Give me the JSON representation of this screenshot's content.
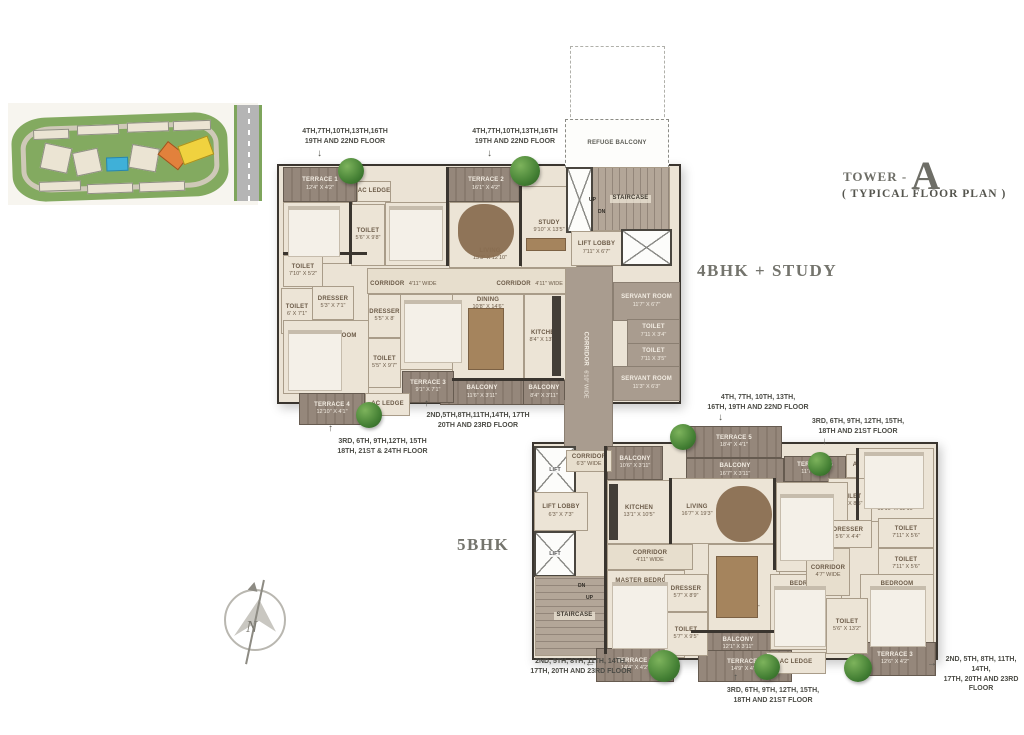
{
  "title": {
    "prefix": "TOWER -",
    "letter": "A",
    "subtitle": "( TYPICAL FLOOR PLAN )"
  },
  "units": {
    "upper": "4BHK + STUDY",
    "lower": "5BHK"
  },
  "compass": {
    "north": "N"
  },
  "upper_plan": {
    "notes": {
      "top_left_1": "4TH,7TH,10TH,13TH,16TH",
      "top_left_2": "19TH AND 22ND  FLOOR",
      "top_mid_1": "4TH,7TH,10TH,13TH,16TH",
      "top_mid_2": "19TH AND 22ND  FLOOR",
      "bottom_right_1": "2ND,5TH,8TH,11TH,14TH, 17TH",
      "bottom_right_2": "20TH AND 23RD FLOOR",
      "bottom_left_1": "3RD, 6TH, 9TH,12TH, 15TH",
      "bottom_left_2": "18TH, 21ST & 24TH  FLOOR"
    },
    "rooms": {
      "terrace1": {
        "name": "TERRACE 1",
        "dims": "12'4\" X 4'2\""
      },
      "bedroom2": {
        "name": "BEDROOM- 2",
        "dims": "11'8\" X 12'0\""
      },
      "ac_ledge": {
        "name": "AC LEDGE"
      },
      "toilet_bed2": {
        "name": "TOILET",
        "dims": "5'6\" X 9'8\""
      },
      "bedroom3": {
        "name": "BEDROOM- 3",
        "dims": "11'8\" X 12'3\""
      },
      "terrace2": {
        "name": "TERRACE 2",
        "dims": "16'1\" X 4'2\""
      },
      "living": {
        "name": "LIVING",
        "dims": "13'3\" X 12'10\""
      },
      "study": {
        "name": "STUDY",
        "dims": "9'10\" X 13'5\""
      },
      "refuge_balcony": {
        "name": "REFUGE BALCONY"
      },
      "staircase": {
        "name": "STAIRCASE"
      },
      "up": {
        "name": "UP"
      },
      "dn": {
        "name": "DN"
      },
      "lift_lobby": {
        "name": "LIFT LOBBY",
        "dims": "7'11\" X 6'7\""
      },
      "toilet_master1": {
        "name": "TOILET",
        "dims": "7'10\" X 5'2\""
      },
      "toilet_master2": {
        "name": "TOILET",
        "dims": "6' X 7'1\""
      },
      "dresser_master": {
        "name": "DRESSER",
        "dims": "5'3\" X 7'1\""
      },
      "master_bedroom": {
        "name": "MASTER BEDROOM",
        "dims": "17'0\" X 11'2\""
      },
      "corridor_h": {
        "name": "CORRIDOR",
        "dims": "4'11\" WIDE"
      },
      "bedroom4": {
        "name": "BEDROOM- 4",
        "dims": "10'2\" X 12'10\""
      },
      "dresser2": {
        "name": "DRESSER",
        "dims": "5'5\" X 8'"
      },
      "toilet_bed4": {
        "name": "TOILET",
        "dims": "5'5\" X 9'7\""
      },
      "dining": {
        "name": "DINING",
        "dims": "10'8\" X 14'6\""
      },
      "kitchen": {
        "name": "KITCHEN",
        "dims": "8'4\" X 13'10\""
      },
      "balcony_dining": {
        "name": "BALCONY",
        "dims": "11'6\" X 3'11\""
      },
      "balcony_kitchen": {
        "name": "BALCONY",
        "dims": "8'4\" X 3'11\""
      },
      "corridor_v": {
        "name": "CORRIDOR",
        "dims": "6'10\" WIDE"
      },
      "servant1": {
        "name": "SERVANT ROOM",
        "dims": "11'7\" X 6'7\""
      },
      "toilet_serv1": {
        "name": "TOILET",
        "dims": "7'11 X 3'4\""
      },
      "toilet_serv2": {
        "name": "TOILET",
        "dims": "7'11 X 3'5\""
      },
      "servant2": {
        "name": "SERVANT ROOM",
        "dims": "11'3\" X 6'3\""
      },
      "terrace3": {
        "name": "TERRACE 3",
        "dims": "9'1\" X 7'1\""
      },
      "terrace4": {
        "name": "TERRACE 4",
        "dims": "12'10\" X 4'1\""
      }
    }
  },
  "lower_plan": {
    "notes": {
      "top_left_1": "4TH, 7TH, 10TH, 13TH,",
      "top_left_2": "16TH, 19TH AND 22ND  FLOOR",
      "top_right_1": "3RD, 6TH, 9TH, 12TH, 15TH,",
      "top_right_2": "18TH AND 21ST FLOOR",
      "bottom_left_1": "2ND, 5TH, 8TH, 11TH, 14TH,",
      "bottom_left_2": "17TH, 20TH AND 23RD FLOOR",
      "bottom_mid_1": "3RD, 6TH, 9TH, 12TH, 15TH,",
      "bottom_mid_2": "18TH AND 21ST FLOOR",
      "bottom_right_1": "2ND, 5TH, 8TH, 11TH, 14TH,",
      "bottom_right_2": "17TH, 20TH AND 23RD FLOOR"
    },
    "rooms": {
      "corridor_top": {
        "name": "CORRIDOR",
        "dims": "6'3\" WIDE"
      },
      "lift": {
        "name": "LIFT"
      },
      "lift_lobby": {
        "name": "LIFT LOBBY",
        "dims": "6'3\" X 7'3\""
      },
      "staircase": {
        "name": "STAIRCASE"
      },
      "up": {
        "name": "UP"
      },
      "dn": {
        "name": "DN"
      },
      "terrace5": {
        "name": "TERRACE 5",
        "dims": "18'4\" X 4'1\""
      },
      "balcony_top": {
        "name": "BALCONY",
        "dims": "16'7\" X 3'11\""
      },
      "terrace4": {
        "name": "TERRACE 4",
        "dims": "11'7\" X 4'1\""
      },
      "ac_ledge": {
        "name": "AC LEDGE"
      },
      "balcony_left": {
        "name": "BALCONY",
        "dims": "10'6\" X 3'11\""
      },
      "kitchen": {
        "name": "KITCHEN",
        "dims": "13'1\" X 10'5\""
      },
      "living": {
        "name": "LIVING",
        "dims": "16'7\" X 19'3\""
      },
      "corridor_mid": {
        "name": "CORRIDOR",
        "dims": "4'11\" WIDE"
      },
      "master_bedroom": {
        "name": "MASTER BEDROOM",
        "dims": "11'3\" X 17'7\""
      },
      "dresser_master": {
        "name": "DRESSER",
        "dims": "5'7\" X 8'9\""
      },
      "toilet_master": {
        "name": "TOILET",
        "dims": "5'7\" X 9'5\""
      },
      "dining": {
        "name": "DINING",
        "dims": "12'5\" X 14'0\""
      },
      "balcony_bottom": {
        "name": "BALCONY",
        "dims": "12'1\" X 3'11\""
      },
      "terrace1": {
        "name": "TERRACE 1",
        "dims": "14'4\" X 4'2\""
      },
      "terrace2": {
        "name": "TERRACE 2",
        "dims": "14'9\" X 4'2\""
      },
      "bedroom_tr": {
        "name": "BEDROOM",
        "dims": "13'10\" X 12'10\""
      },
      "toilet_tr": {
        "name": "TOILET",
        "dims": "5'6\" X 8'5\""
      },
      "bedroom_mid": {
        "name": "BEDROOM",
        "dims": "10'2\" X 15'2\""
      },
      "dresser_right": {
        "name": "DRESSER",
        "dims": "5'6\" X 4'4\""
      },
      "toilet_r1": {
        "name": "TOILET",
        "dims": "7'11\" X 5'6\""
      },
      "toilet_r2": {
        "name": "TOILET",
        "dims": "7'11\" X 5'6\""
      },
      "corridor_right": {
        "name": "CORRIDOR",
        "dims": "4'7\" WIDE"
      },
      "bedroom_bl": {
        "name": "BEDROOM",
        "dims": "10'3\" X 13'2\""
      },
      "toilet_center": {
        "name": "TOILET",
        "dims": "5'6\" X 13'2\""
      },
      "bedroom_br": {
        "name": "BEDROOM",
        "dims": "11'10\" X 12'10\""
      },
      "terrace3": {
        "name": "TERRACE 3",
        "dims": "12'6\" X 4'2\""
      }
    }
  }
}
